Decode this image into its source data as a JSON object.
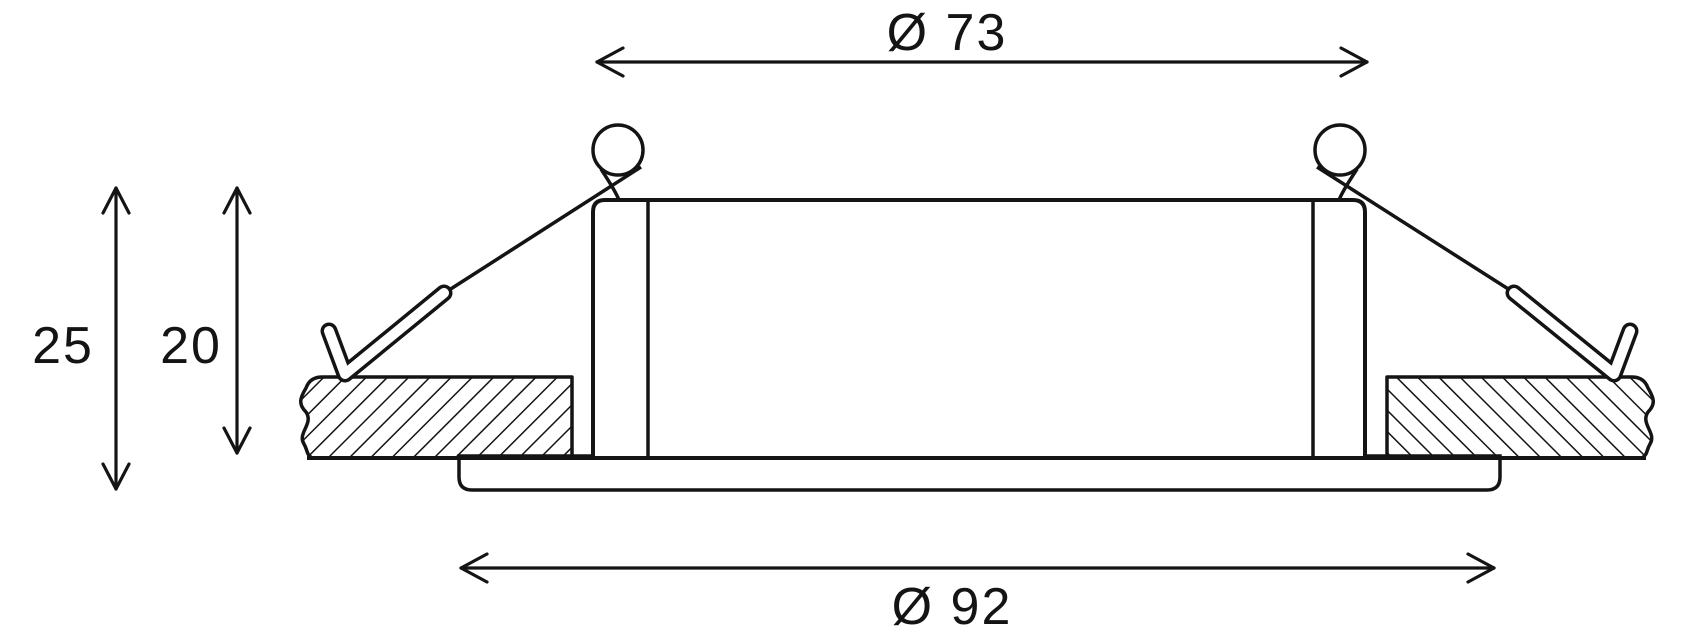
{
  "page": {
    "background": "#ffffff",
    "line_color": "#141414",
    "title": "recessed downlight dimension drawing"
  },
  "drawing": {
    "type": "technical-dimension-cross-section",
    "labels": {
      "diameter_top": "Ø 73",
      "diameter_bottom": "Ø 92",
      "height_left": "25",
      "height_right": "20"
    },
    "values": {
      "diameter_top": 73,
      "diameter_bottom": 92,
      "height_left": 25,
      "height_right": 20
    }
  }
}
